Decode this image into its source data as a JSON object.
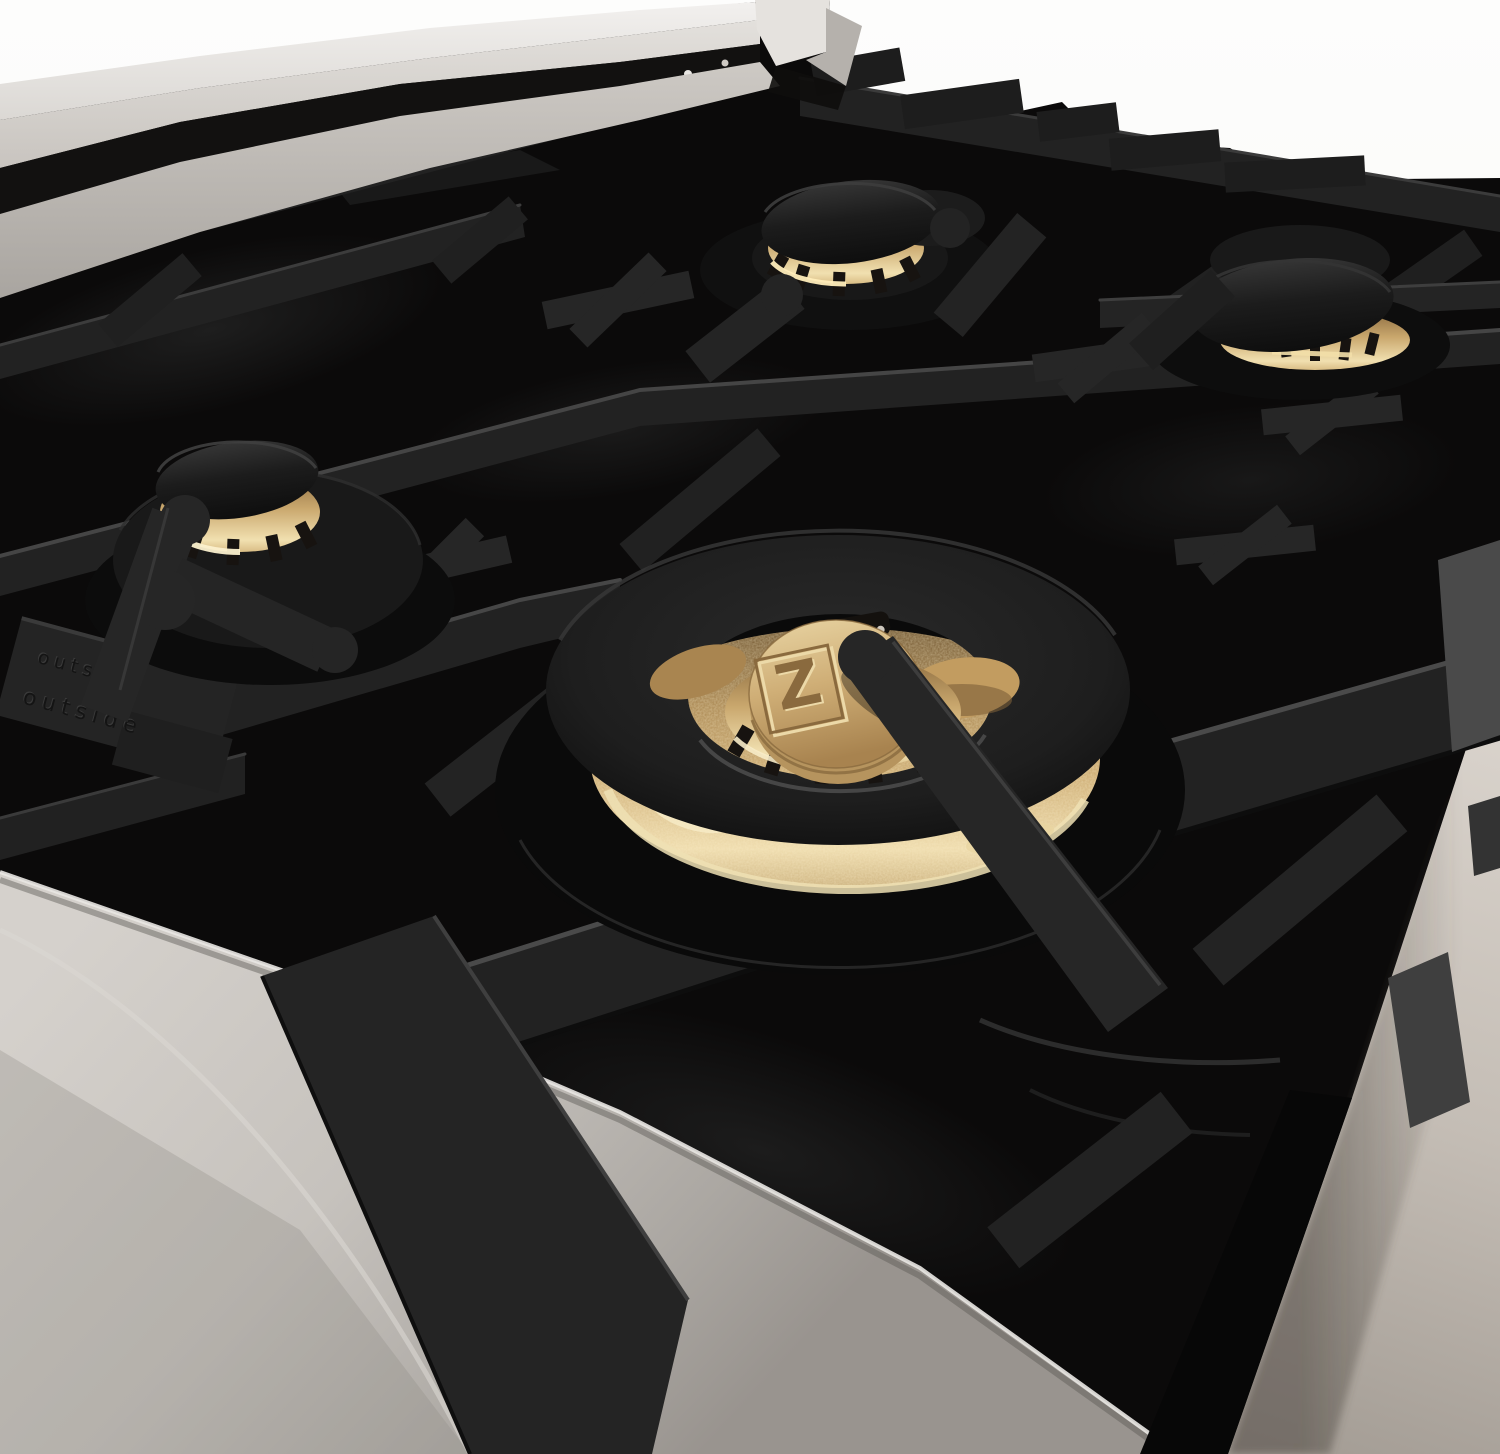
{
  "image": {
    "type": "product-photo",
    "subject": "Close-up of a gas rangetop cooktop with black porcelain surface, black cast-iron grates, stainless steel trim and brass burners"
  },
  "branding": {
    "logo_letter": "Z",
    "brand_vertical": "ZLINE"
  },
  "grate": {
    "embossed_text_top": "outside",
    "embossed_text_bottom": "outside"
  },
  "colors": {
    "bg_white": "#fdfdfc",
    "bg_beige_light": "#ddd7d0",
    "bg_beige_dark": "#a29b93",
    "steel_bright": "#f2f0ee",
    "steel_mid": "#c6c2bd",
    "steel_dark": "#99948f",
    "porcelain_black": "#0b0a0a",
    "iron_face": "#222222",
    "iron_highlight": "#474747",
    "brass_light": "#f1e0b0",
    "brass_mid": "#c9a76d",
    "brass_deep": "#8a6a3e",
    "cap_dark": "#1c1c1c"
  }
}
